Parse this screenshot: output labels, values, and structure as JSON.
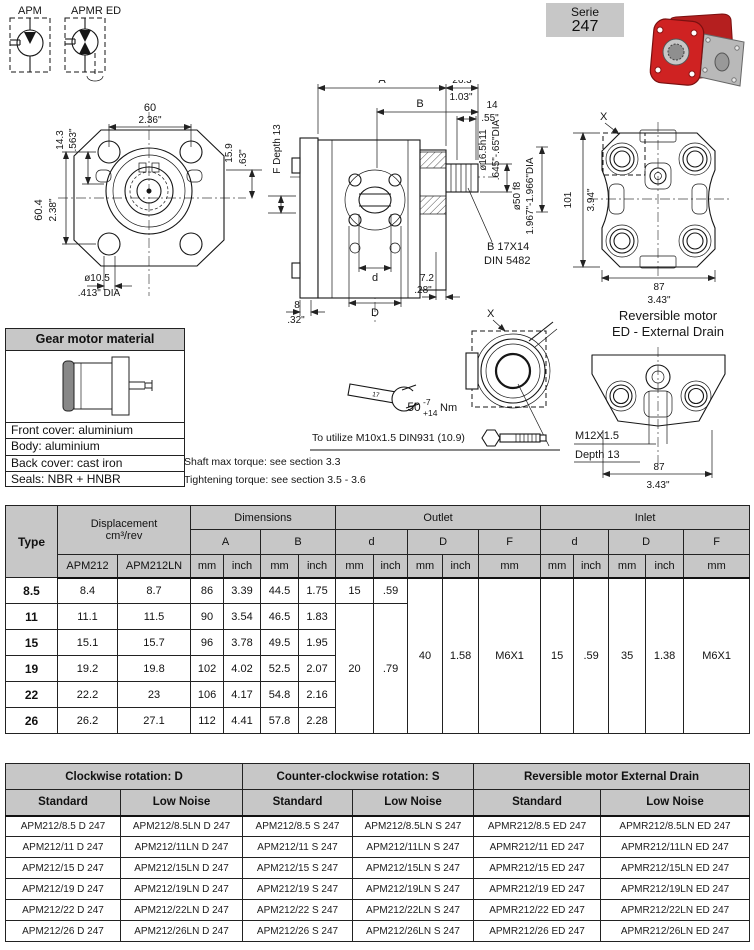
{
  "symbols": {
    "apm": "APM",
    "apmr": "APMR ED"
  },
  "serie": {
    "label": "Serie",
    "number": "247"
  },
  "front_view": {
    "w_mm": "60",
    "w_in": "2.36\"",
    "off_mm": "14.3",
    "off_in": ".563\"",
    "h_mm": "60.4",
    "h_in": "2.38\"",
    "key_mm": "15.9",
    "key_in": ".63\"",
    "f_depth": "F Depth 13",
    "hole": "ø10.5",
    "hole_in": ".413\" DIA"
  },
  "side_view": {
    "a": "A",
    "b": "B",
    "len_mm": "26.3",
    "len_in": "1.03\"",
    "shaft_len_mm": "14",
    "shaft_len_in": ".55\"",
    "shaft_dia": "ø16.5h11",
    "shaft_dia_in": ".645\"-.65\"DIA",
    "pilot_dia": "ø50 f8",
    "pilot_dia_in": "1.967\"-1.966\"DIA",
    "spline1": "B 17X14",
    "spline2": "DIN 5482",
    "d_small": "d",
    "off_mm": "7.2",
    "off_in": ".28\"",
    "plate_mm": "8",
    "plate_in": ".32\"",
    "d_big": "D"
  },
  "back_view": {
    "x": "X",
    "h_mm": "101",
    "h_in": "3.94\"",
    "w_mm": "87",
    "w_in": "3.43\"",
    "caption1": "Reversible motor",
    "caption2": "ED - External Drain"
  },
  "detail_x": {
    "x": "X"
  },
  "ed_view": {
    "thread": "M12X1.5",
    "depth": "Depth 13",
    "w_mm": "87",
    "w_in": "3.43\""
  },
  "notes": {
    "wrench_mark": "17",
    "torque": "50",
    "tol_minus": "-7",
    "tol_plus": "+14",
    "unit": "Nm",
    "bolt": "To utilize  M10x1.5 DIN931 (10.9)",
    "shaft": "Shaft max torque: see section 3.3",
    "tightening": "Tightening torque: see section 3.5 - 3.6"
  },
  "material_box": {
    "title": "Gear motor material",
    "rows": [
      "Front cover: aluminium",
      "Body: aluminium",
      "Back cover: cast iron",
      "Seals: NBR + HNBR"
    ]
  },
  "spec_table": {
    "col_type": "Type",
    "col_displacement": "Displacement",
    "col_unit": "cm³/rev",
    "col_apm212": "APM212",
    "col_apm212ln": "APM212LN",
    "col_dimensions": "Dimensions",
    "col_outlet": "Outlet",
    "col_inlet": "Inlet",
    "col_a": "A",
    "col_b": "B",
    "col_d": "d",
    "col_D": "D",
    "col_F": "F",
    "mm": "mm",
    "inch": "inch",
    "rows": [
      {
        "type": "8.5",
        "apm212": "8.4",
        "apm212ln": "8.7",
        "a_mm": "86",
        "a_in": "3.39",
        "b_mm": "44.5",
        "b_in": "1.75"
      },
      {
        "type": "11",
        "apm212": "11.1",
        "apm212ln": "11.5",
        "a_mm": "90",
        "a_in": "3.54",
        "b_mm": "46.5",
        "b_in": "1.83"
      },
      {
        "type": "15",
        "apm212": "15.1",
        "apm212ln": "15.7",
        "a_mm": "96",
        "a_in": "3.78",
        "b_mm": "49.5",
        "b_in": "1.95"
      },
      {
        "type": "19",
        "apm212": "19.2",
        "apm212ln": "19.8",
        "a_mm": "102",
        "a_in": "4.02",
        "b_mm": "52.5",
        "b_in": "2.07"
      },
      {
        "type": "22",
        "apm212": "22.2",
        "apm212ln": "23",
        "a_mm": "106",
        "a_in": "4.17",
        "b_mm": "54.8",
        "b_in": "2.16"
      },
      {
        "type": "26",
        "apm212": "26.2",
        "apm212ln": "27.1",
        "a_mm": "112",
        "a_in": "4.41",
        "b_mm": "57.8",
        "b_in": "2.28"
      }
    ],
    "outlet": {
      "d_mm_first": "15",
      "d_in_first": ".59",
      "d_mm_rest": "20",
      "d_in_rest": ".79",
      "D_mm": "40",
      "D_in": "1.58",
      "F": "M6X1"
    },
    "inlet": {
      "d_mm": "15",
      "d_in": ".59",
      "D_mm": "35",
      "D_in": "1.38",
      "F": "M6X1"
    }
  },
  "order_table": {
    "groups": [
      "Clockwise rotation: D",
      "Counter-clockwise rotation: S",
      "Reversible motor External Drain"
    ],
    "sub": [
      "Standard",
      "Low Noise",
      "Standard",
      "Low Noise",
      "Standard",
      "Low Noise"
    ],
    "rows": [
      [
        "APM212/8.5 D 247",
        "APM212/8.5LN D 247",
        "APM212/8.5 S 247",
        "APM212/8.5LN S 247",
        "APMR212/8.5 ED 247",
        "APMR212/8.5LN ED 247"
      ],
      [
        "APM212/11 D 247",
        "APM212/11LN D 247",
        "APM212/11 S 247",
        "APM212/11LN S 247",
        "APMR212/11 ED 247",
        "APMR212/11LN ED 247"
      ],
      [
        "APM212/15 D 247",
        "APM212/15LN D 247",
        "APM212/15 S 247",
        "APM212/15LN S 247",
        "APMR212/15 ED 247",
        "APMR212/15LN ED 247"
      ],
      [
        "APM212/19 D 247",
        "APM212/19LN D 247",
        "APM212/19 S 247",
        "APM212/19LN S 247",
        "APMR212/19 ED 247",
        "APMR212/19LN ED 247"
      ],
      [
        "APM212/22 D 247",
        "APM212/22LN D 247",
        "APM212/22 S 247",
        "APM212/22LN S 247",
        "APMR212/22 ED 247",
        "APMR212/22LN ED 247"
      ],
      [
        "APM212/26 D 247",
        "APM212/26LN D 247",
        "APM212/26 S 247",
        "APM212/26LN S 247",
        "APMR212/26 ED 247",
        "APMR212/26LN ED 247"
      ]
    ]
  },
  "colors": {
    "header_gray": "#c7c7c7",
    "pump_red": "#c41e1e",
    "line": "#161616"
  }
}
